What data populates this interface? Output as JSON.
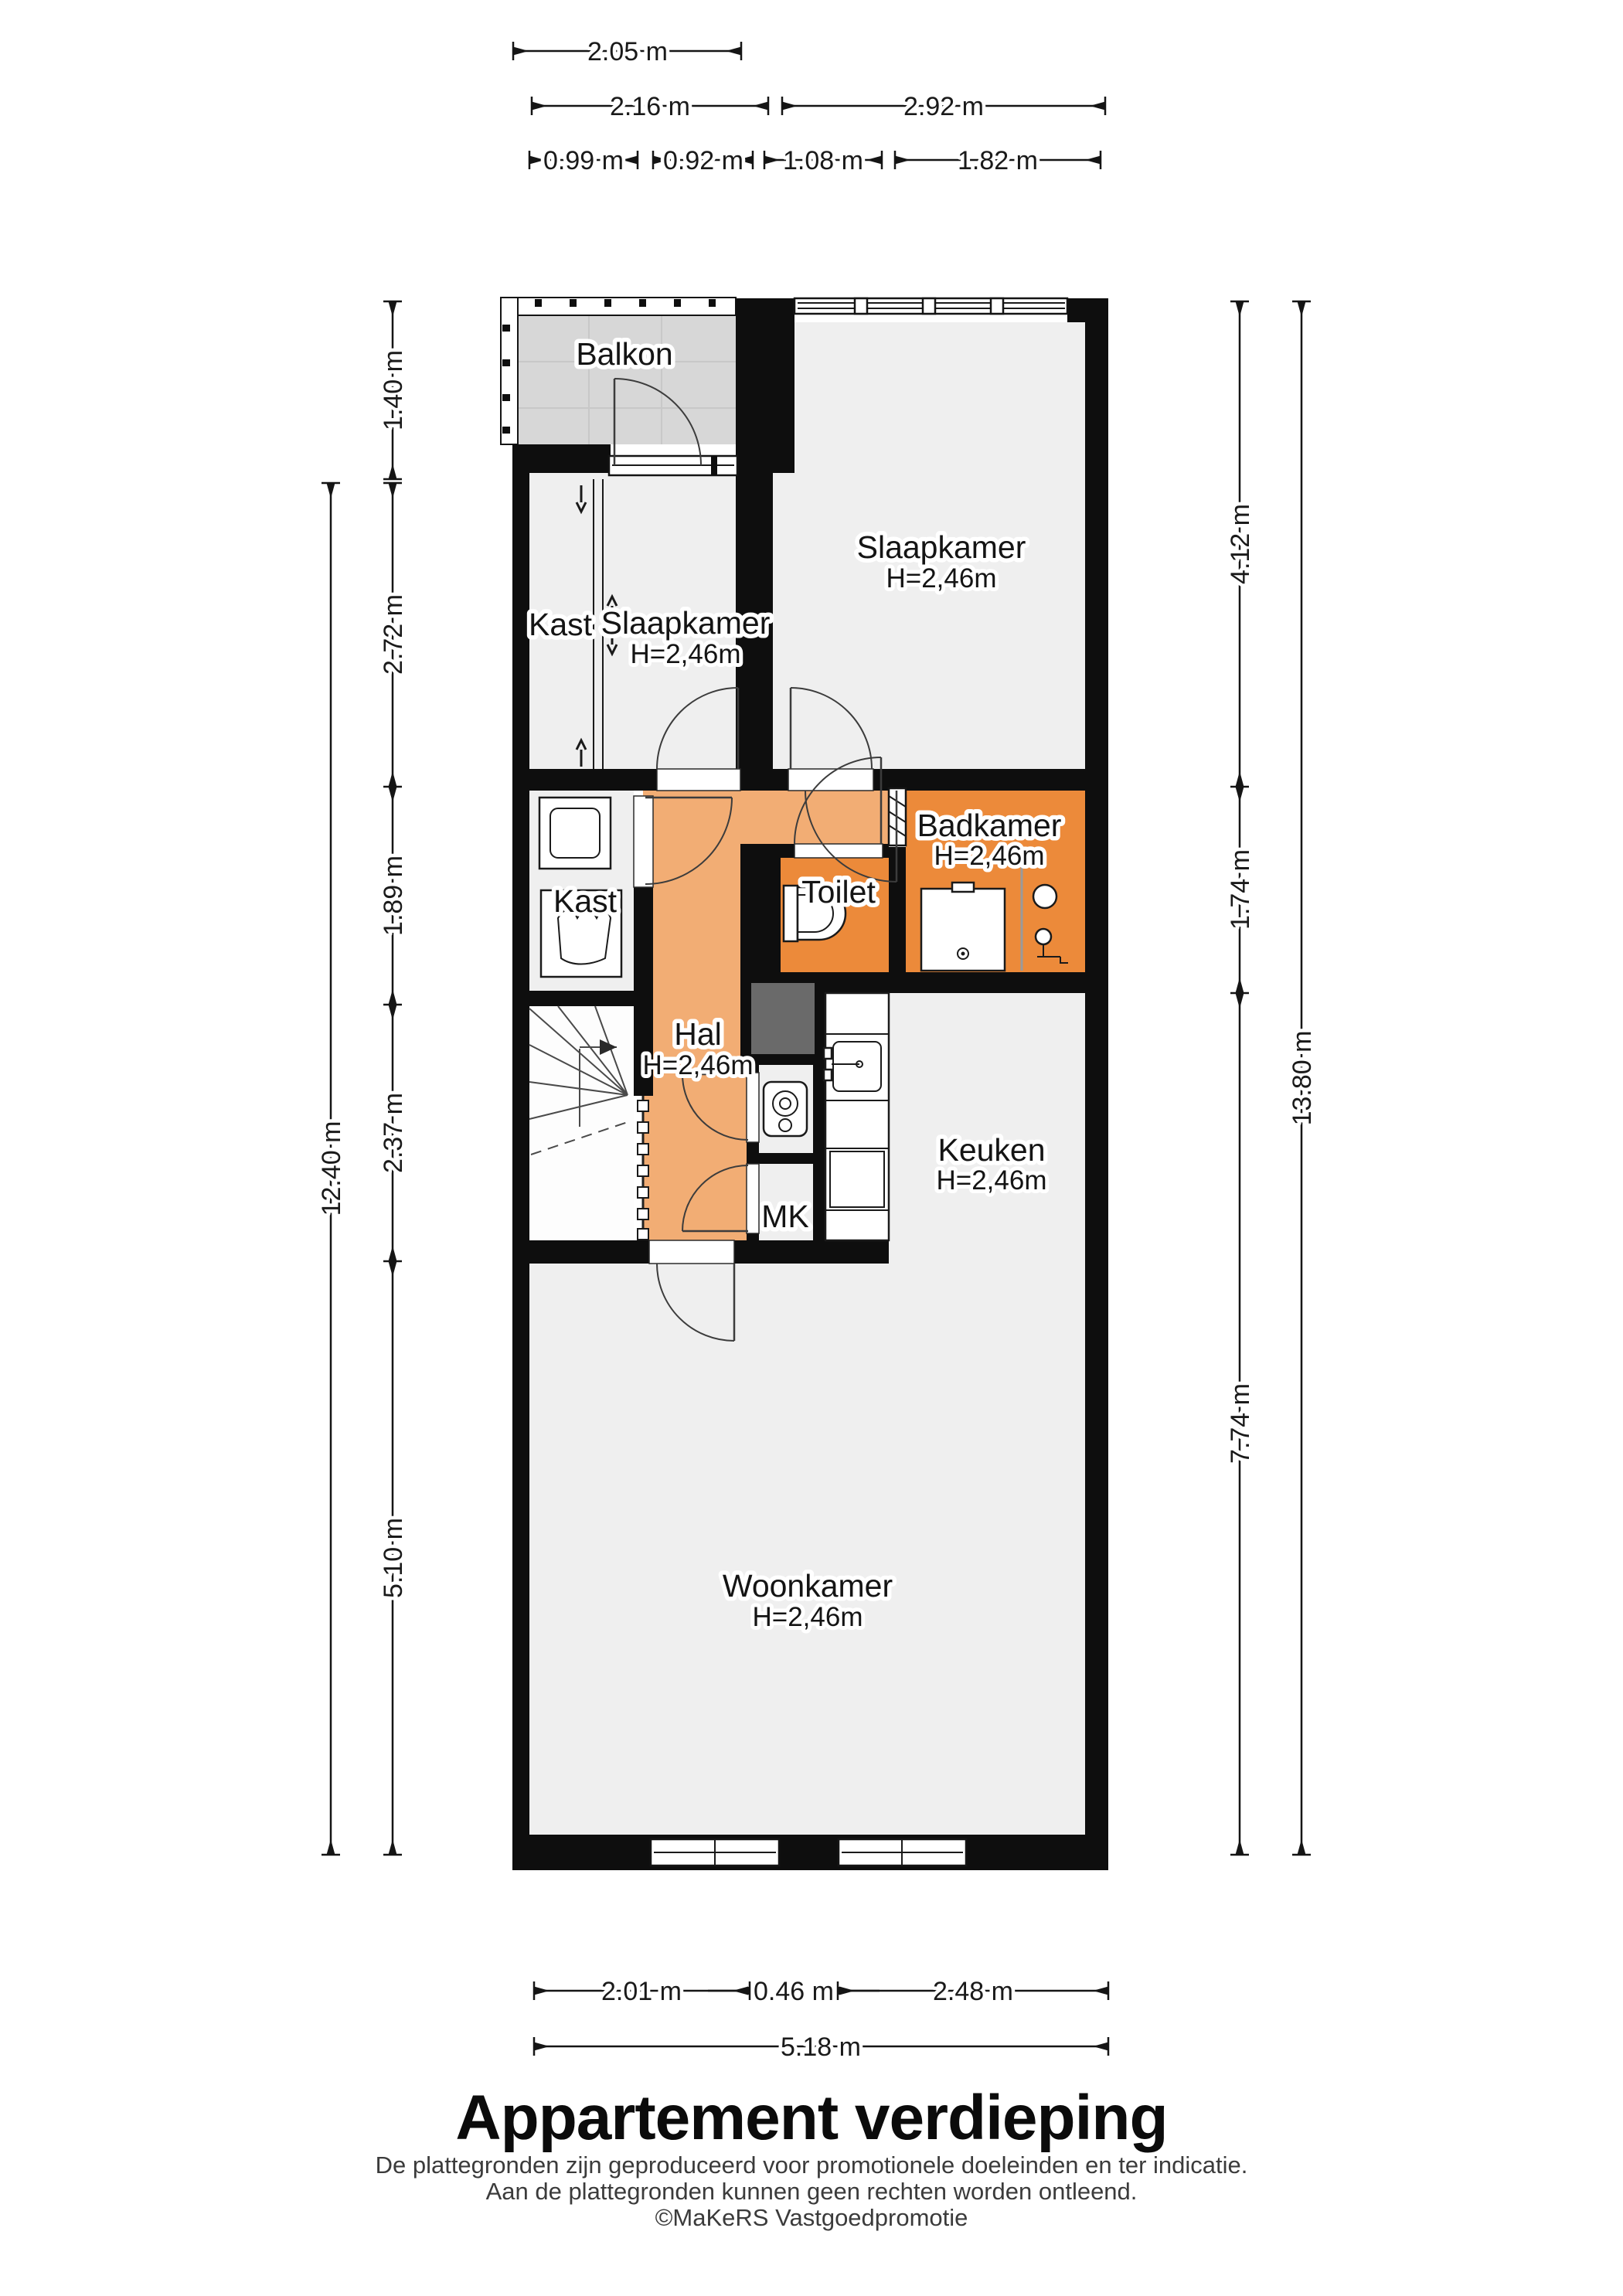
{
  "colors": {
    "wall": "#0e0e0e",
    "floor": "#efefef",
    "hal_orange": "#f2ad74",
    "wet_orange": "#ec8a3a",
    "balcony_gray": "#d7d7d7",
    "shaft_gray": "#6a6a6a"
  },
  "rooms": {
    "balkon": {
      "name": "Balkon"
    },
    "kast_upper": {
      "name": "Kast"
    },
    "slaapkamer_left": {
      "name": "Slaapkamer",
      "height": "H=2,46m"
    },
    "slaapkamer_right": {
      "name": "Slaapkamer",
      "height": "H=2,46m"
    },
    "kast_lower": {
      "name": "Kast"
    },
    "badkamer": {
      "name": "Badkamer",
      "height": "H=2,46m"
    },
    "toilet": {
      "name": "Toilet"
    },
    "hal": {
      "name": "Hal",
      "height": "H=2,46m"
    },
    "keuken": {
      "name": "Keuken",
      "height": "H=2,46m"
    },
    "mk": {
      "name": "MK"
    },
    "woonkamer": {
      "name": "Woonkamer",
      "height": "H=2,46m"
    }
  },
  "dimensions": {
    "top": {
      "d1": "2.05 m",
      "d2": "2.16 m",
      "d3": "2.92 m",
      "d4": "0.99 m",
      "d5": "0.92 m",
      "d6": "1.08 m",
      "d7": "1.82 m"
    },
    "bottom": {
      "d1": "2.01 m",
      "d2": "0.46 m",
      "d3": "2.48 m",
      "total": "5.18 m"
    },
    "left": {
      "d1": "1.40 m",
      "d2": "2.72 m",
      "d3": "1.89 m",
      "d4": "2.37 m",
      "d5": "5.10 m",
      "total": "12.40 m"
    },
    "right": {
      "d1": "4.12 m",
      "d2": "1.74 m",
      "d3": "7.74 m",
      "total": "13.80 m"
    }
  },
  "footer": {
    "title": "Appartement verdieping",
    "disclaimer1": "De plattegronden zijn geproduceerd voor promotionele doeleinden en ter indicatie.",
    "disclaimer2": "Aan de plattegronden kunnen geen rechten worden ontleend.",
    "copyright": "©MaKeRS Vastgoedpromotie"
  }
}
